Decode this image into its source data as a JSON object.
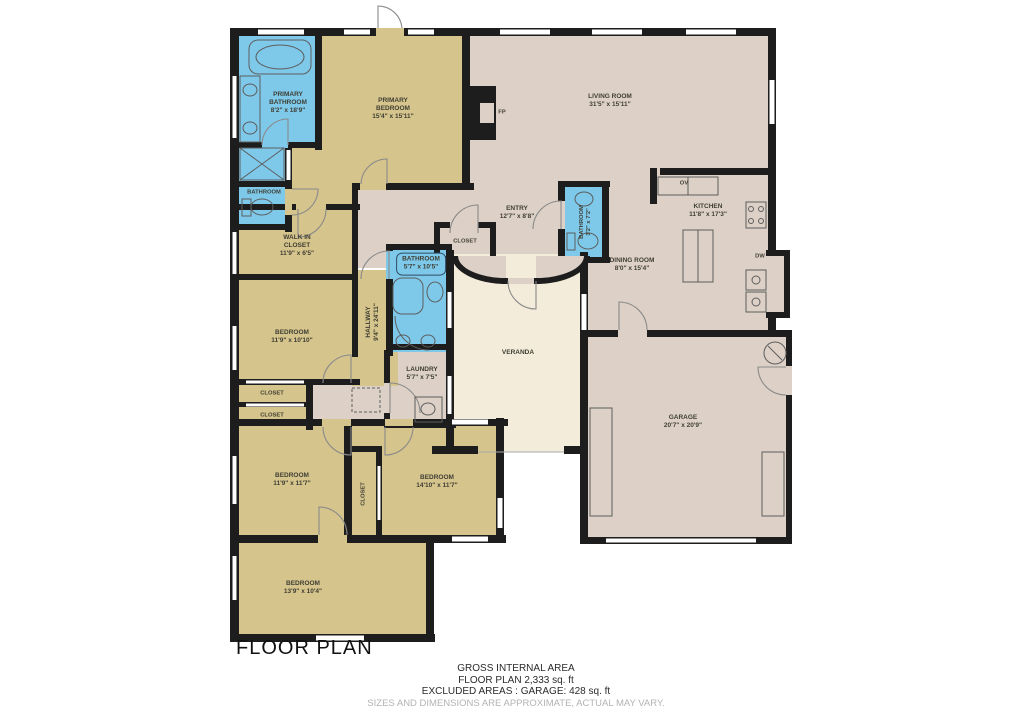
{
  "title": "FLOOR PLAN",
  "rooms": {
    "primary_bathroom": {
      "name": "PRIMARY BATHROOM",
      "dims": "8'2\" x 18'9\""
    },
    "small_bathroom": {
      "name": "BATHROOM",
      "dims": ""
    },
    "primary_bedroom": {
      "name": "PRIMARY BEDROOM",
      "dims": "15'4\" x 15'11\""
    },
    "living_room": {
      "name": "LIVING ROOM",
      "dims": "31'5\" x 15'11\""
    },
    "entry": {
      "name": "ENTRY",
      "dims": "12'7\" x 8'8\""
    },
    "entry_closet": {
      "name": "CLOSET",
      "dims": ""
    },
    "powder_bathroom": {
      "name": "BATHROOM",
      "dims": "3'2\" x 7'2\""
    },
    "kitchen": {
      "name": "KITCHEN",
      "dims": "11'8\" x 17'3\""
    },
    "dining_room": {
      "name": "DINING ROOM",
      "dims": "8'0\" x 15'4\""
    },
    "walk_in_closet": {
      "name": "WALK IN CLOSET",
      "dims": "11'9\" x 6'5\""
    },
    "hallway": {
      "name": "HALLWAY",
      "dims": "9'4\" x 24'11\""
    },
    "hall_bathroom": {
      "name": "BATHROOM",
      "dims": "5'7\" x 10'5\""
    },
    "laundry": {
      "name": "LAUNDRY",
      "dims": "5'7\" x 7'5\""
    },
    "bedroom1": {
      "name": "BEDROOM",
      "dims": "11'9\" x 10'10\""
    },
    "closet_a": {
      "name": "CLOSET",
      "dims": ""
    },
    "closet_b": {
      "name": "CLOSET",
      "dims": ""
    },
    "bedroom2": {
      "name": "BEDROOM",
      "dims": "11'9\" x 11'7\""
    },
    "closet_v": {
      "name": "CLOSET",
      "dims": ""
    },
    "bedroom3": {
      "name": "BEDROOM",
      "dims": "14'10\" x 11'7\""
    },
    "bedroom4": {
      "name": "BEDROOM",
      "dims": "13'9\" x 10'4\""
    },
    "veranda": {
      "name": "VERANDA",
      "dims": ""
    },
    "garage": {
      "name": "GARAGE",
      "dims": "20'7\" x 20'9\""
    }
  },
  "markers": {
    "fireplace": "FP",
    "oven": "OV",
    "dishwasher": "DW"
  },
  "footer": {
    "line1": "GROSS INTERNAL AREA",
    "line2": "FLOOR PLAN 2,333 sq. ft",
    "line3": "EXCLUDED AREAS :  GARAGE: 428 sq. ft",
    "line4": "SIZES AND DIMENSIONS ARE APPROXIMATE, ACTUAL MAY VARY."
  },
  "colors": {
    "floor_open": "#ddd1c7",
    "floor_bedroom": "#d5c48c",
    "floor_bath": "#7ec9ea",
    "floor_veranda": "#f3ecda",
    "wall": "#1d1d1d"
  }
}
